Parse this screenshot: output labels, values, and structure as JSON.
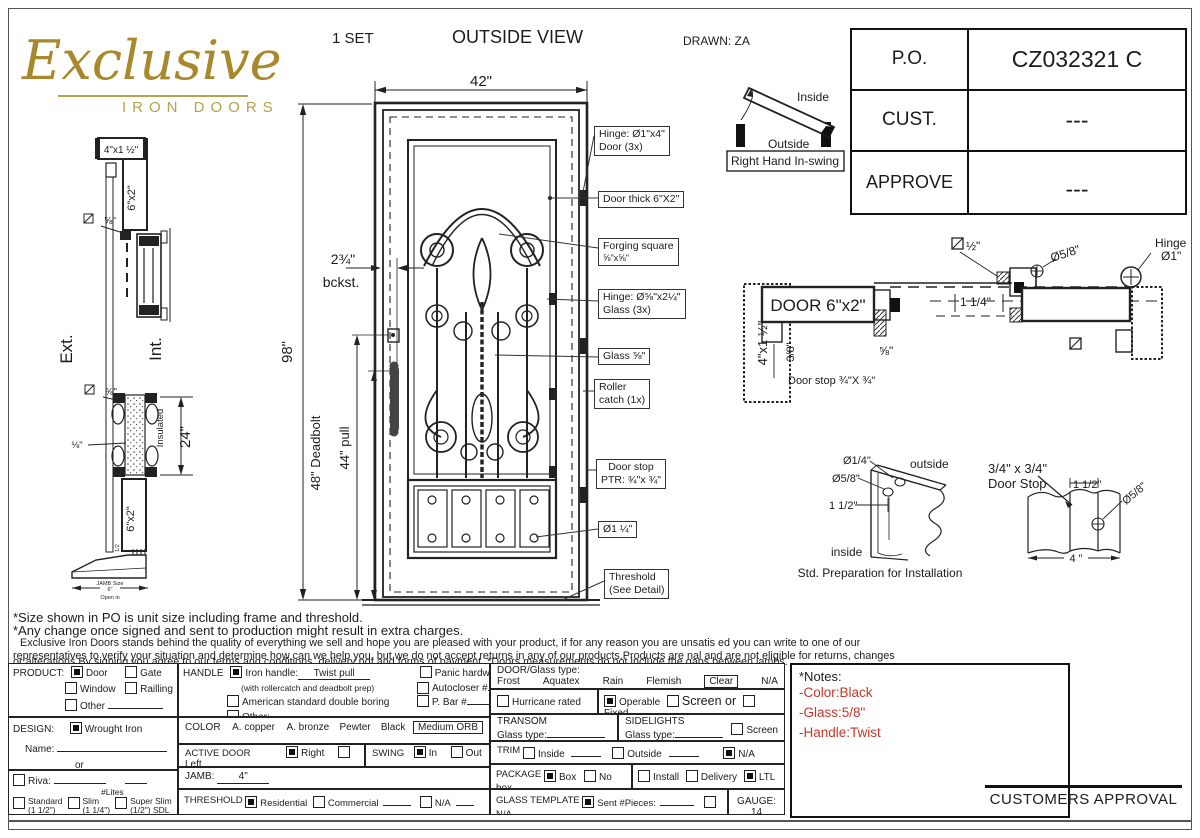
{
  "colors": {
    "logo_gold": "#a9882b",
    "note_red": "#c0392b"
  },
  "logo": {
    "name": "Exclusive",
    "sub": "IRON DOORS"
  },
  "header": {
    "set": "1  SET",
    "title": "OUTSIDE VIEW",
    "drawn": "DRAWN: ZA"
  },
  "title_block": {
    "rows": [
      {
        "label": "P.O.",
        "value": "CZ032321 C"
      },
      {
        "label": "CUST.",
        "value": "---"
      },
      {
        "label": "APPROVE",
        "value": "---"
      }
    ]
  },
  "drawing": {
    "side": {
      "top": "4\"x1 ½\"",
      "m6x2a": "6\"x2\"",
      "m6x2b": "6\"x2\"",
      "five8a": "⅝\"",
      "five8b": "⅝\"",
      "ext": "Ext.",
      "int": "Int.",
      "insulated": "Insulated",
      "d24": "24\"",
      "d18": "⅛\"",
      "half": "1/2",
      "jamb1": "JAMB Size",
      "jamb2": "6\"",
      "jamb3": "Open in"
    },
    "door": {
      "w": "42\"",
      "h": "98\"",
      "backset": "2¾\"",
      "bckst": "bckst.",
      "deadbolt": "48\" Deadbolt",
      "pull": "44\" pull"
    },
    "callouts": [
      {
        "l1": "Hinge: Ø1\"x4\"",
        "l2": "Door (3x)"
      },
      {
        "l1": "Door thick 6\"X2\"",
        "l2": ""
      },
      {
        "l1": "Forging square",
        "l2": "⅝\"x⅝\""
      },
      {
        "l1": "Hinge: Ø⅝\"x2¼\"",
        "l2": "Glass (3x)"
      },
      {
        "l1": "Glass ⅝\"",
        "l2": ""
      },
      {
        "l1": "Roller",
        "l2": "catch  (1x)"
      },
      {
        "l1": "Door stop",
        "l2": "PTR: ¾\"x ¾\""
      },
      {
        "l1": "Ø1 ¼\"",
        "l2": ""
      },
      {
        "l1": "Threshold",
        "l2": "(See Detail)"
      }
    ],
    "swing": {
      "inside": "Inside",
      "outside": "Outside",
      "label": "Right Hand In-swing"
    },
    "plan": {
      "jamb": "4\"x1 ½\"",
      "door": "DOOR 6\"x2\"",
      "d38": "3/8\"",
      "stop": "Door stop ¾\"X ¾\"",
      "five8": "⅝\"",
      "d114": "1 1/4\"",
      "d58": "Ø5/8\"",
      "half": "½\"",
      "hinge1": "Hinge",
      "hinge2": "Ø1\""
    },
    "prep": {
      "d14": "Ø1/4\"",
      "d58": "Ø5/8\"",
      "d112": "1 1/2\"",
      "outside": "outside",
      "inside": "inside",
      "caption": "Std. Preparation for Installation"
    },
    "stopdetail": {
      "t1": "3/4\" x 3/4\"",
      "t2": "Door Stop",
      "d112": "1 1/2\"",
      "d58": "Ø5/8\"",
      "d4": "4 \""
    }
  },
  "notes": {
    "line1": "*Size shown in PO is unit size including frame and threshold.",
    "line2": "*Any change once signed and sent to production might result in extra charges.",
    "line3": "Exclusive Iron Doors stands behind the quality of everything we sell and hope you are pleased with your product, if for any reason you are unsatis  ed you can write to one of our",
    "line4": "representatives to verify your situation and determine how can we help you, but we do not accept returns in any of our products.Products are   nal and are not eligible for returns, changes",
    "line5": "or alterations.By signing you agree to our terms and conditions, delivery pdf and forms of payment. *Doors measurements do not include the gaps between jambs."
  },
  "form": {
    "product": {
      "label": "PRODUCT:",
      "opts": [
        {
          "label": "Door",
          "checked": true
        },
        {
          "label": "Gate",
          "checked": false
        },
        {
          "label": "Window",
          "checked": false
        },
        {
          "label": "Railling",
          "checked": false
        },
        {
          "label": "Other",
          "checked": false
        }
      ]
    },
    "handle": {
      "label": "HANDLE",
      "iron": {
        "label": "Iron handle:",
        "value": "Twist pull",
        "checked": true
      },
      "iron_note": "(with rollercatch and deadbolt prep)",
      "american": {
        "label": "American standard double boring",
        "checked": false
      },
      "other": {
        "label": "Other:",
        "checked": false
      },
      "panic": {
        "label": "Panic hardware",
        "checked": false
      },
      "autocloser": {
        "label": "Autocloser #",
        "checked": false
      },
      "pbar": {
        "label": "P. Bar #",
        "checked": false
      }
    },
    "design": {
      "label": "DESIGN:",
      "opt": {
        "label": "Wrought Iron",
        "checked": true
      },
      "name_label": "Name:",
      "or": "or"
    },
    "riva": {
      "label": "Riva:",
      "checked": false
    },
    "lites": {
      "header": "#Lites",
      "opts": [
        {
          "label": "Standard",
          "sub": "(1 1/2\")",
          "checked": false
        },
        {
          "label": "Slim",
          "sub": "(1 1/4\")",
          "checked": false
        },
        {
          "label": "Super Slim",
          "sub": "(1/2\") SDL",
          "checked": false
        }
      ]
    },
    "color": {
      "label": "COLOR",
      "opts": [
        "A. copper",
        "A. bronze",
        "Pewter",
        "Black"
      ],
      "selected": "Medium ORB"
    },
    "active": {
      "label": "ACTIVE DOOR",
      "opts": [
        {
          "label": "Right",
          "checked": true
        },
        {
          "label": "Left",
          "checked": false
        }
      ]
    },
    "swing": {
      "label": "SWING",
      "opts": [
        {
          "label": "In",
          "checked": true
        },
        {
          "label": "Out",
          "checked": false
        }
      ]
    },
    "jamb": {
      "label": "JAMB:",
      "value": "4\""
    },
    "threshold": {
      "label": "THRESHOLD",
      "opts": [
        {
          "label": "Residential",
          "checked": true
        },
        {
          "label": "Commercial",
          "checked": false
        },
        {
          "label": "N/A",
          "checked": false
        }
      ]
    },
    "doorglass": {
      "label": "DOOR/Glass type:",
      "opts": [
        "Frost",
        "Aquatex",
        "Rain",
        "Flemish",
        "Clear",
        "N/A"
      ],
      "selected": "Clear"
    },
    "hurricane": {
      "label": "Hurricane rated",
      "checked": false
    },
    "operable": {
      "opts": [
        {
          "label": "Operable",
          "checked": true
        },
        {
          "label": "Screen or",
          "checked": false
        },
        {
          "label": "Fixed",
          "checked": false
        }
      ]
    },
    "transom": {
      "label": "TRANSOM",
      "glass": "Glass type:"
    },
    "sidelights": {
      "label": "SIDELIGHTS",
      "glass": "Glass type:",
      "screen": {
        "label": "Screen",
        "checked": false
      }
    },
    "trim": {
      "label": "TRIM",
      "opts": [
        {
          "label": "Inside",
          "checked": false
        },
        {
          "label": "Outside",
          "checked": false
        },
        {
          "label": "N/A",
          "checked": true
        }
      ]
    },
    "package": {
      "label": "PACKAGE",
      "opts": [
        {
          "label": "Box",
          "checked": true
        },
        {
          "label": "No box",
          "checked": false
        },
        {
          "label": "Install",
          "checked": false
        },
        {
          "label": "Delivery",
          "checked": false
        },
        {
          "label": "LTL",
          "checked": true
        }
      ]
    },
    "glasstemplate": {
      "label": "GLASS TEMPLATE",
      "sent": {
        "label": "Sent #Pieces:",
        "checked": true
      },
      "na": {
        "label": "N/A",
        "checked": false
      }
    },
    "gauge": "GAUGE: 14"
  },
  "side_notes": {
    "title": "*Notes:",
    "items": [
      "-Color:Black",
      "-Glass:5/8\"",
      "-Handle:Twist"
    ]
  },
  "approval": "CUSTOMERS APPROVAL"
}
